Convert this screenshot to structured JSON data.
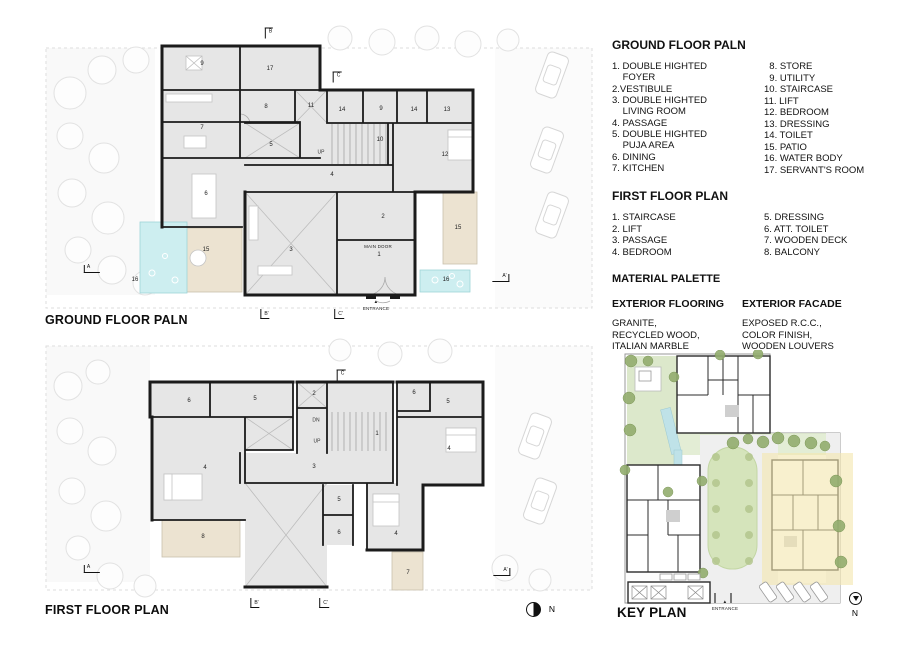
{
  "colors": {
    "wall": "#1b1b1b",
    "room_fill": "#e6e6e6",
    "patio_beige": "#ece3d1",
    "water_cyan": "#cdeef0",
    "lawn_green": "#dce8cb",
    "highlight_yellow": "#f3e6ae"
  },
  "gf_panel": {
    "caption": "GROUND FLOOR PALN",
    "labels": [
      {
        "t": "9",
        "x": 162,
        "y": 46
      },
      {
        "t": "17",
        "x": 230,
        "y": 51
      },
      {
        "t": "8",
        "x": 226,
        "y": 89
      },
      {
        "t": "11",
        "x": 271,
        "y": 88
      },
      {
        "t": "14",
        "x": 302,
        "y": 92
      },
      {
        "t": "9",
        "x": 341,
        "y": 91
      },
      {
        "t": "14",
        "x": 374,
        "y": 92
      },
      {
        "t": "13",
        "x": 407,
        "y": 92
      },
      {
        "t": "7",
        "x": 162,
        "y": 110
      },
      {
        "t": "5",
        "x": 231,
        "y": 127
      },
      {
        "t": "10",
        "x": 340,
        "y": 122
      },
      {
        "t": "12",
        "x": 405,
        "y": 137
      },
      {
        "t": "6",
        "x": 166,
        "y": 176
      },
      {
        "t": "4",
        "x": 292,
        "y": 157
      },
      {
        "t": "2",
        "x": 343,
        "y": 199
      },
      {
        "t": "3",
        "x": 251,
        "y": 232
      },
      {
        "t": "1",
        "x": 339,
        "y": 237
      },
      {
        "t": "15",
        "x": 166,
        "y": 232
      },
      {
        "t": "15",
        "x": 418,
        "y": 210
      },
      {
        "t": "16",
        "x": 95,
        "y": 262
      },
      {
        "t": "16",
        "x": 406,
        "y": 262
      },
      {
        "t": "UP",
        "x": 281,
        "y": 135,
        "cls": "tn"
      },
      {
        "t": "MAIN DOOR",
        "x": 338,
        "y": 229,
        "cls": "mc"
      },
      {
        "t": "▲",
        "x": 336,
        "y": 284,
        "cls": "mc"
      },
      {
        "t": "ENTRANCE",
        "x": 336,
        "y": 291,
        "cls": "mc"
      },
      {
        "t": "B",
        "x": 229,
        "y": 15,
        "cls": "mk g"
      },
      {
        "t": "C",
        "x": 297,
        "y": 59,
        "cls": "mk g"
      },
      {
        "t": "A",
        "x": 52,
        "y": 251,
        "cls": "mk al"
      },
      {
        "t": "A'",
        "x": 461,
        "y": 260,
        "cls": "mk ar"
      },
      {
        "t": "B'",
        "x": 225,
        "y": 296,
        "cls": "mk l"
      },
      {
        "t": "C'",
        "x": 299,
        "y": 296,
        "cls": "mk l"
      }
    ]
  },
  "ff_panel": {
    "caption": "FIRST FLOOR PLAN",
    "north_label": "N",
    "labels": [
      {
        "t": "6",
        "x": 149,
        "y": 65
      },
      {
        "t": "5",
        "x": 215,
        "y": 63
      },
      {
        "t": "2",
        "x": 274,
        "y": 58
      },
      {
        "t": "1",
        "x": 337,
        "y": 98
      },
      {
        "t": "6",
        "x": 374,
        "y": 57
      },
      {
        "t": "5",
        "x": 408,
        "y": 66
      },
      {
        "t": "4",
        "x": 409,
        "y": 113
      },
      {
        "t": "3",
        "x": 274,
        "y": 131
      },
      {
        "t": "4",
        "x": 165,
        "y": 132
      },
      {
        "t": "5",
        "x": 299,
        "y": 164
      },
      {
        "t": "6",
        "x": 299,
        "y": 197
      },
      {
        "t": "4",
        "x": 356,
        "y": 198
      },
      {
        "t": "8",
        "x": 163,
        "y": 201
      },
      {
        "t": "7",
        "x": 368,
        "y": 237
      },
      {
        "t": "DN",
        "x": 276,
        "y": 85,
        "cls": "tn"
      },
      {
        "t": "UP",
        "x": 277,
        "y": 106,
        "cls": "tn"
      },
      {
        "t": "C",
        "x": 301,
        "y": 39,
        "cls": "mk g"
      },
      {
        "t": "A",
        "x": 52,
        "y": 233,
        "cls": "mk al"
      },
      {
        "t": "A'",
        "x": 462,
        "y": 236,
        "cls": "mk ar"
      },
      {
        "t": "B'",
        "x": 215,
        "y": 267,
        "cls": "mk l"
      },
      {
        "t": "C'",
        "x": 284,
        "y": 267,
        "cls": "mk l"
      },
      {
        "t": "N",
        "x": 512,
        "y": 273,
        "cls": "nb"
      }
    ]
  },
  "legend": {
    "gf": {
      "title": "GROUND FLOOR PALN",
      "col1": [
        "1. DOUBLE HIGHTED\n    FOYER",
        "2.VESTIBULE",
        "3. DOUBLE HIGHTED\n    LIVING ROOM",
        "4. PASSAGE",
        "5. DOUBLE HIGHTED\n    PUJA AREA",
        "6. DINING",
        "7. KITCHEN"
      ],
      "col2": [
        "  8. STORE",
        "  9. UTILITY",
        "10. STAIRCASE",
        "11. LIFT",
        "12. BEDROOM",
        "13. DRESSING",
        "14. TOILET",
        "15. PATIO",
        "16. WATER BODY",
        "17. SERVANT'S ROOM"
      ]
    },
    "ff": {
      "title": "FIRST FLOOR PLAN",
      "col1": [
        "1. STAIRCASE",
        "2. LIFT",
        "3. PASSAGE",
        "4. BEDROOM"
      ],
      "col2": [
        "5. DRESSING",
        "6. ATT. TOILET",
        "7. WOODEN DECK",
        "8. BALCONY"
      ]
    },
    "materials": {
      "title": "MATERIAL PALETTE",
      "flooring_title": "EXTERIOR FLOORING",
      "flooring_text": "GRANITE,\nRECYCLED WOOD,\nITALIAN MARBLE",
      "facade_title": "EXTERIOR FACADE",
      "facade_text": "EXPOSED R.C.C.,\nCOLOR FINISH,\nWOODEN LOUVERS"
    }
  },
  "key_panel": {
    "caption": "KEY PLAN",
    "north_label": "N",
    "labels": [
      {
        "t": "▲",
        "x": 117,
        "y": 252,
        "cls": "mc"
      },
      {
        "t": "ENTRANCE",
        "x": 117,
        "y": 259,
        "cls": "mc"
      },
      {
        "t": "N",
        "x": 247,
        "y": 263,
        "cls": "nb"
      }
    ]
  }
}
